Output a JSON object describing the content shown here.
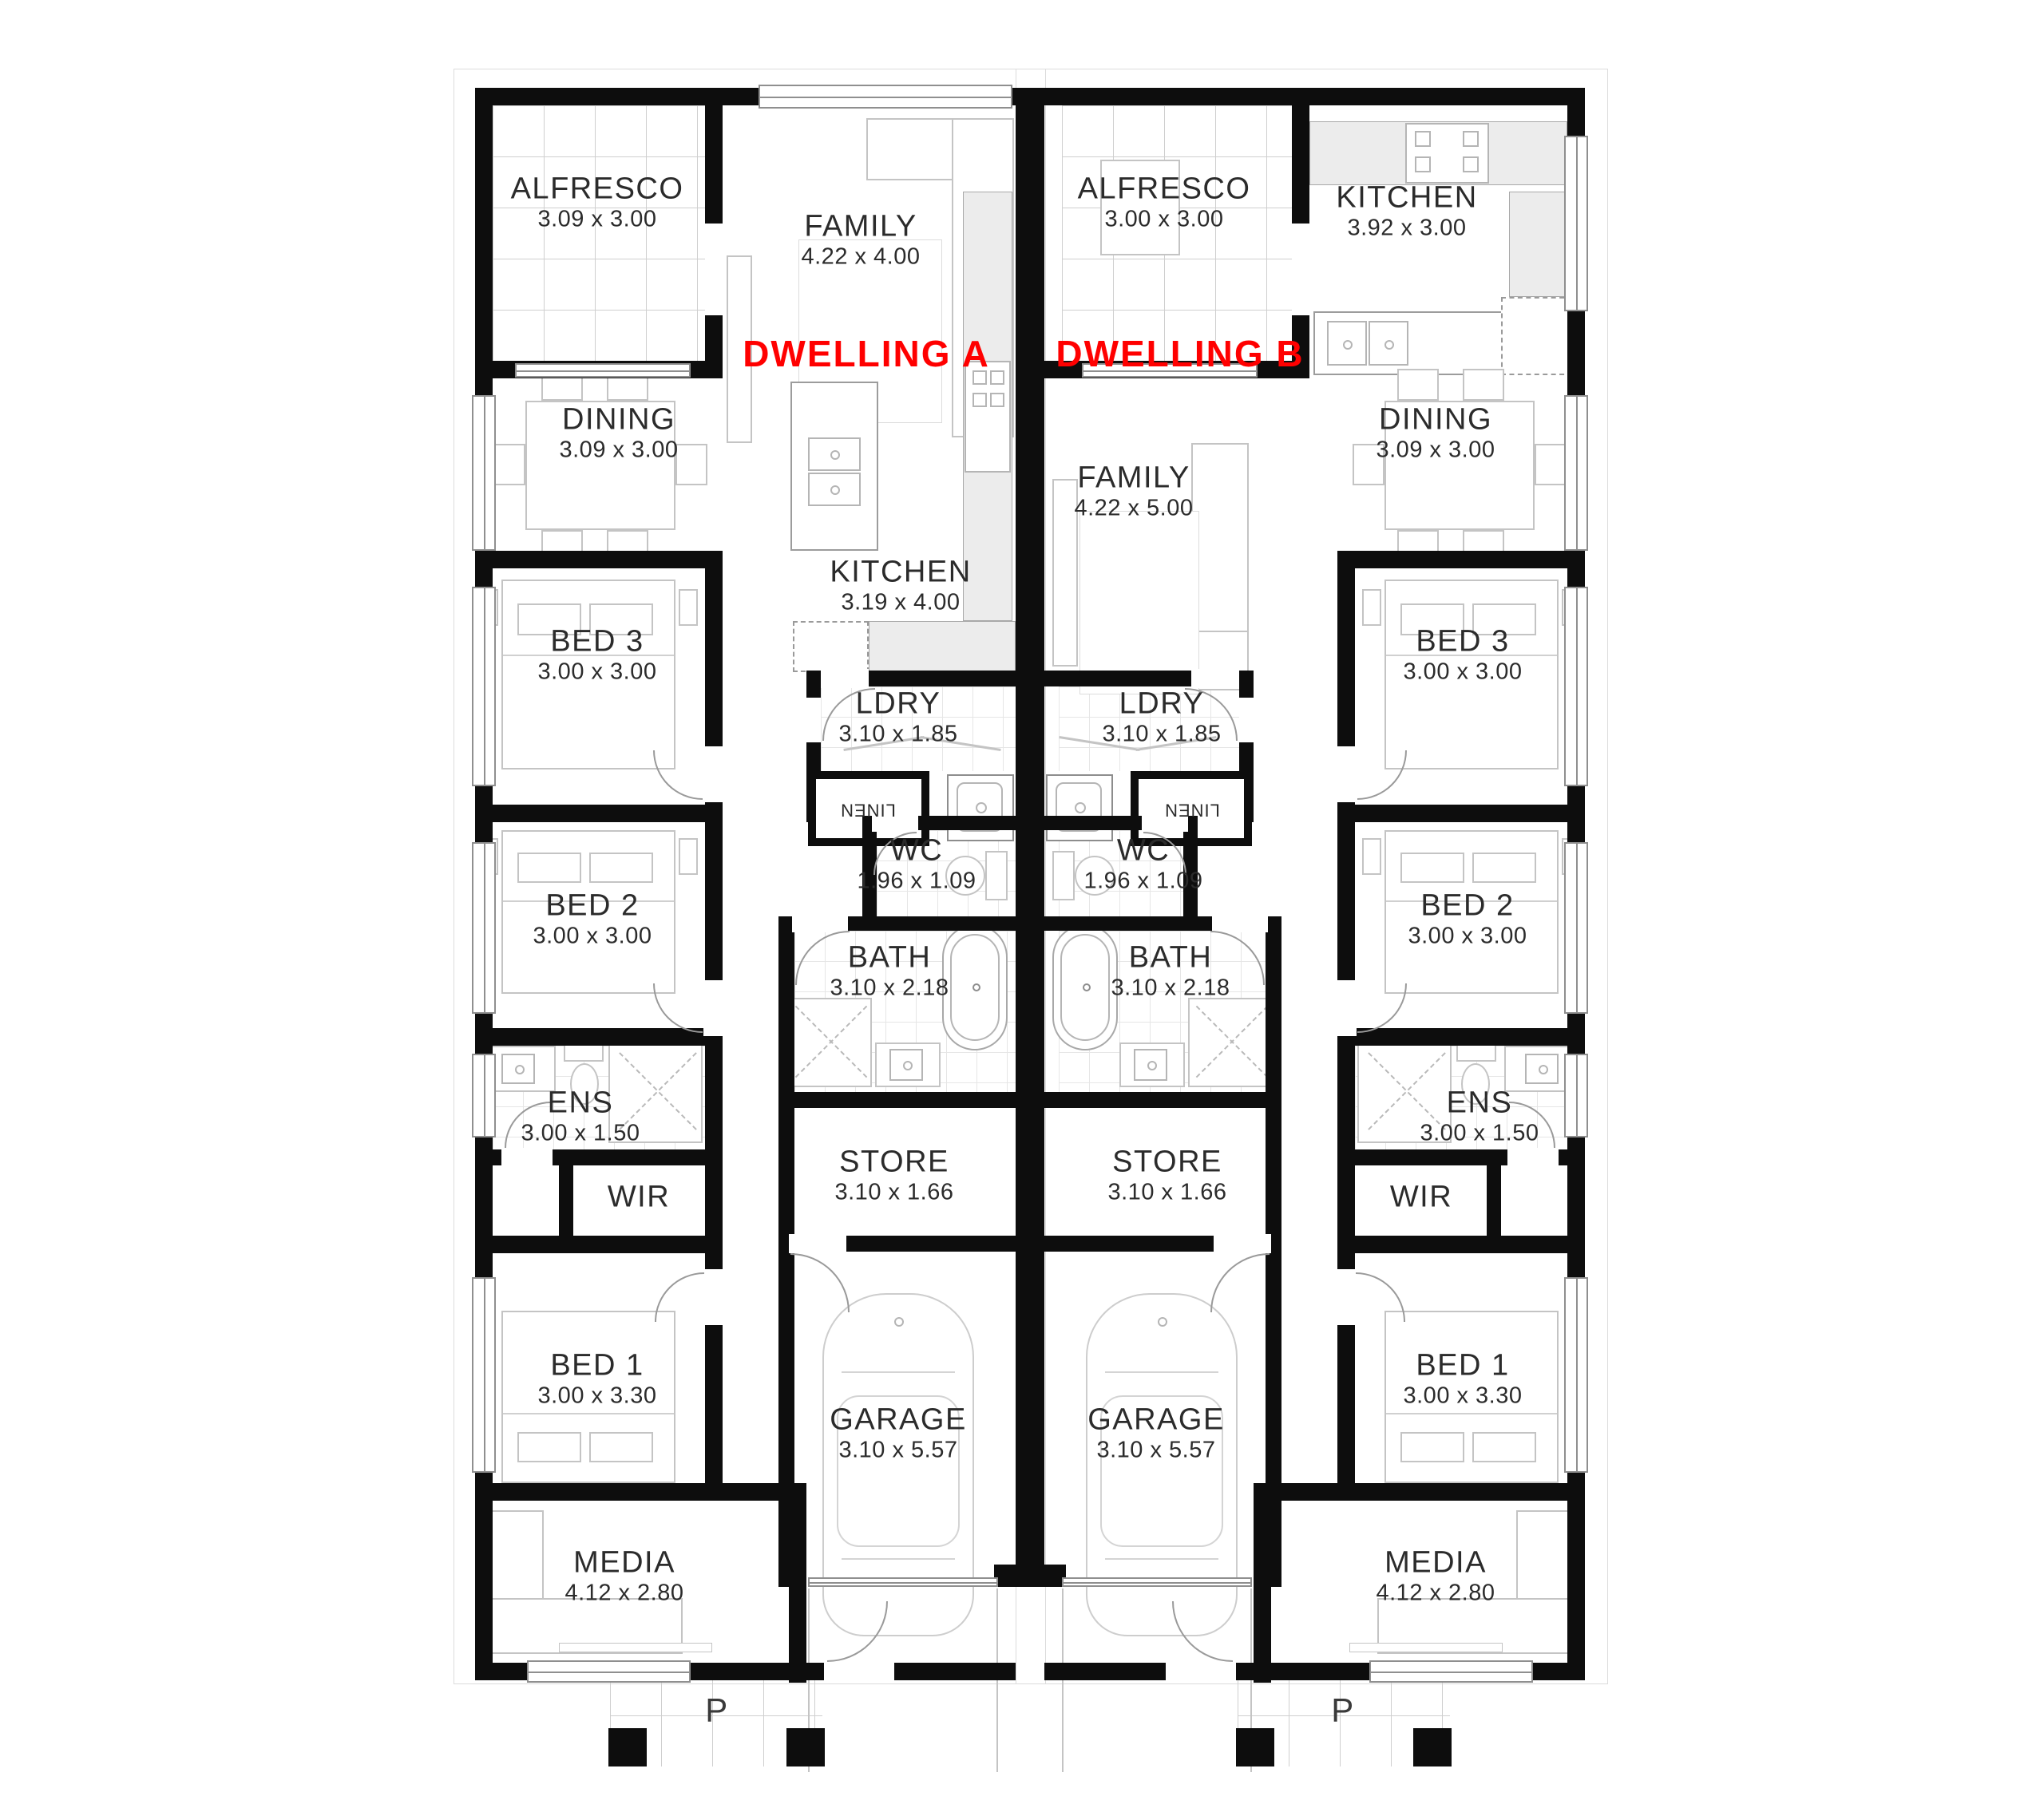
{
  "plan_title": "Duplex floor plan",
  "colors": {
    "wall": "#0d0d0d",
    "dwelling_label": "#ff0000",
    "room_text": "#2b2b2b",
    "furniture_line": "#c4c4c4",
    "bench_fill": "#ececec",
    "tile_line": "#cfcfcf"
  },
  "dwelling_a": {
    "title": "DWELLING A",
    "rooms": {
      "alfresco": {
        "name": "ALFRESCO",
        "dims": "3.09 x 3.00"
      },
      "family": {
        "name": "FAMILY",
        "dims": "4.22 x 4.00"
      },
      "dining": {
        "name": "DINING",
        "dims": "3.09 x 3.00"
      },
      "kitchen": {
        "name": "KITCHEN",
        "dims": "3.19 x 4.00"
      },
      "bed3": {
        "name": "BED 3",
        "dims": "3.00 x 3.00"
      },
      "ldry": {
        "name": "LDRY",
        "dims": "3.10 x 1.85"
      },
      "linen": {
        "name": "LINEN"
      },
      "wc": {
        "name": "WC",
        "dims": "1.96 x 1.09"
      },
      "bed2": {
        "name": "BED 2",
        "dims": "3.00 x 3.00"
      },
      "bath": {
        "name": "BATH",
        "dims": "3.10 x 2.18"
      },
      "ens": {
        "name": "ENS",
        "dims": "3.00 x 1.50"
      },
      "wir": {
        "name": "WIR"
      },
      "store": {
        "name": "STORE",
        "dims": "3.10 x 1.66"
      },
      "bed1": {
        "name": "BED 1",
        "dims": "3.00 x 3.30"
      },
      "garage": {
        "name": "GARAGE",
        "dims": "3.10 x 5.57"
      },
      "media": {
        "name": "MEDIA",
        "dims": "4.12 x 2.80"
      },
      "porch": {
        "name": "P"
      }
    }
  },
  "dwelling_b": {
    "title": "DWELLING B",
    "rooms": {
      "alfresco": {
        "name": "ALFRESCO",
        "dims": "3.00 x 3.00"
      },
      "kitchen": {
        "name": "KITCHEN",
        "dims": "3.92 x 3.00"
      },
      "family": {
        "name": "FAMILY",
        "dims": "4.22 x 5.00"
      },
      "dining": {
        "name": "DINING",
        "dims": "3.09 x 3.00"
      },
      "bed3": {
        "name": "BED 3",
        "dims": "3.00 x 3.00"
      },
      "ldry": {
        "name": "LDRY",
        "dims": "3.10 x 1.85"
      },
      "linen": {
        "name": "LINEN"
      },
      "wc": {
        "name": "WC",
        "dims": "1.96 x 1.09"
      },
      "bed2": {
        "name": "BED 2",
        "dims": "3.00 x 3.00"
      },
      "bath": {
        "name": "BATH",
        "dims": "3.10 x 2.18"
      },
      "ens": {
        "name": "ENS",
        "dims": "3.00 x 1.50"
      },
      "wir": {
        "name": "WIR"
      },
      "store": {
        "name": "STORE",
        "dims": "3.10 x 1.66"
      },
      "bed1": {
        "name": "BED 1",
        "dims": "3.00 x 3.30"
      },
      "garage": {
        "name": "GARAGE",
        "dims": "3.10 x 5.57"
      },
      "media": {
        "name": "MEDIA",
        "dims": "4.12 x 2.80"
      },
      "porch": {
        "name": "P"
      }
    }
  }
}
